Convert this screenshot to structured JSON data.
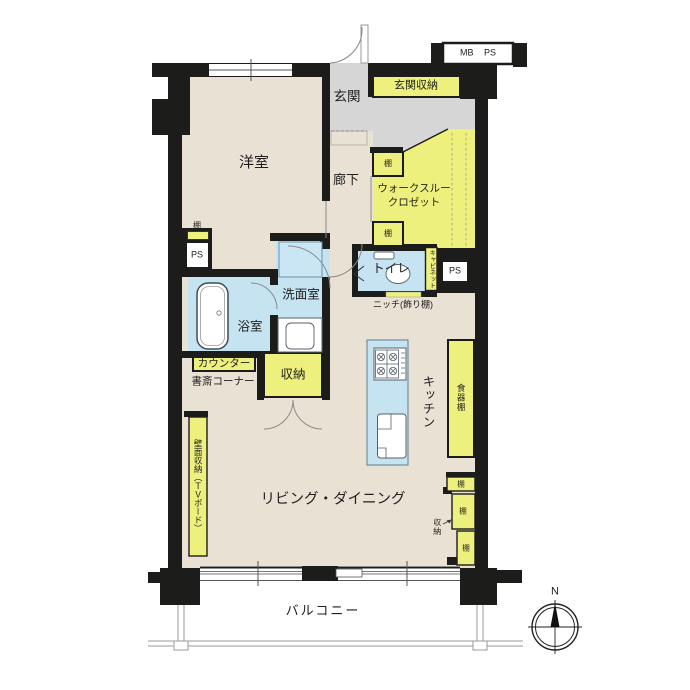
{
  "plan": {
    "rooms": {
      "genkan": "玄関",
      "genkan_storage": "玄関収納",
      "yoshitsu": "洋室",
      "rouka": "廊下",
      "closet_l1": "ウォークスルー",
      "closet_l2": "クロゼット",
      "toilet": "トイレ",
      "niche": "ニッチ(飾り棚)",
      "senmen": "洗面室",
      "yokushitsu": "浴室",
      "counter": "カウンター",
      "shosai": "書斎コーナー",
      "shuno_hall": "収納",
      "kitchen": "キッチン",
      "shokkidana": "食器棚",
      "living": "リビング・ダイニング",
      "kabemen": "壁面収納（ＴＶボード）",
      "shuno_se": "収納",
      "balcony": "バルコニー"
    },
    "tags": {
      "tana": "棚",
      "ps": "PS",
      "mb": "MB",
      "cabinet": "キャビネット",
      "north": "N"
    },
    "colors": {
      "wall": "#1c1c1a",
      "floor": "#e9e1d3",
      "entrance": "#d6d6d6",
      "storage": "#edf07c",
      "water": "#c6e3f2"
    }
  }
}
